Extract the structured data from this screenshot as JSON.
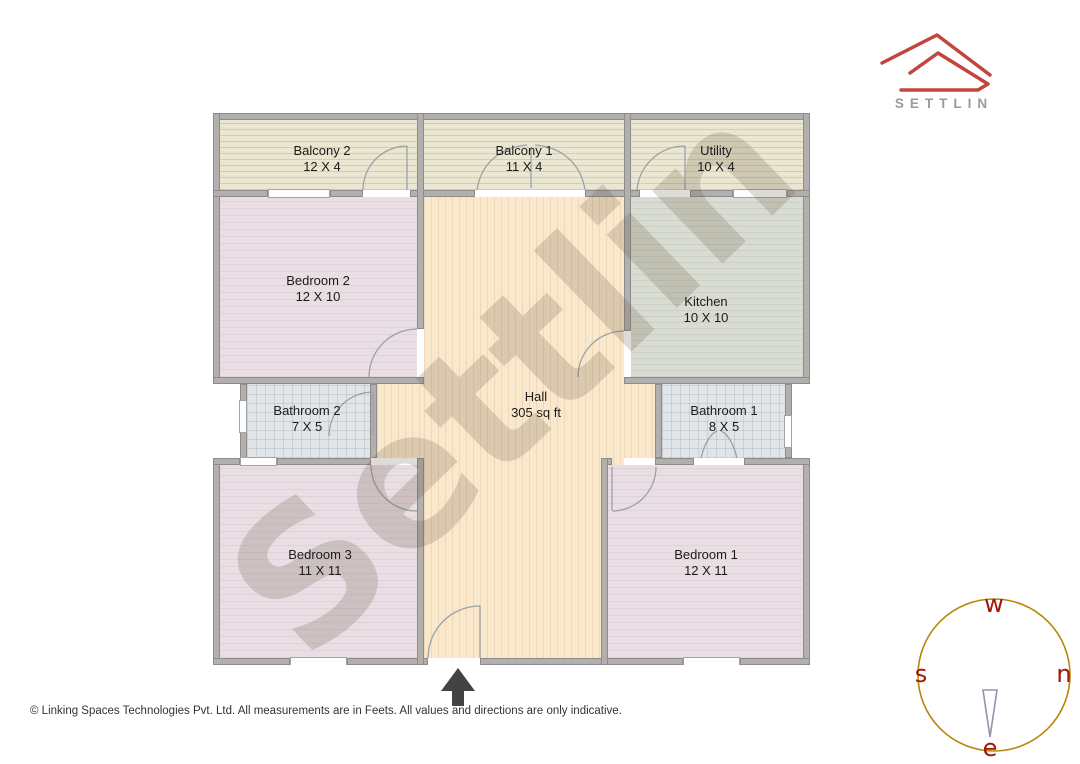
{
  "brand": {
    "name": "SETTLIN"
  },
  "floorplan": {
    "watermark": "Settlin",
    "rooms": [
      {
        "id": "balcony-2",
        "name": "Balcony 2",
        "dims": "12 X 4"
      },
      {
        "id": "balcony-1",
        "name": "Balcony 1",
        "dims": "11 X 4"
      },
      {
        "id": "utility",
        "name": "Utility",
        "dims": "10 X 4"
      },
      {
        "id": "bedroom-2",
        "name": "Bedroom 2",
        "dims": "12 X 10"
      },
      {
        "id": "kitchen",
        "name": "Kitchen",
        "dims": "10 X 10"
      },
      {
        "id": "hall",
        "name": "Hall",
        "dims": "305 sq ft"
      },
      {
        "id": "bathroom-2",
        "name": "Bathroom 2",
        "dims": "7 X 5"
      },
      {
        "id": "bathroom-1",
        "name": "Bathroom 1",
        "dims": "8 X 5"
      },
      {
        "id": "bedroom-3",
        "name": "Bedroom 3",
        "dims": "11 X 11"
      },
      {
        "id": "bedroom-1",
        "name": "Bedroom 1",
        "dims": "12 X 11"
      }
    ]
  },
  "compass": {
    "top": "w",
    "right": "n",
    "bottom": "e",
    "left": "s"
  },
  "footer": {
    "text": "© Linking Spaces Technologies Pvt. Ltd. All measurements are in Feets. All values and directions are only indicative."
  },
  "colors": {
    "logo_red": "#c2453e",
    "brand_gray": "#9b9b9b",
    "wall_gray": "#b2b0af",
    "balcony_floor": "#eae6d1",
    "bedroom_floor": "#e8dee3",
    "hall_floor": "#f9e8cc",
    "kitchen_floor": "#d9dcd3",
    "bathroom_floor": "#e2e5e8",
    "compass_circle": "#b8860b",
    "compass_letters": "#a01508",
    "entrance_arrow": "#434345"
  }
}
